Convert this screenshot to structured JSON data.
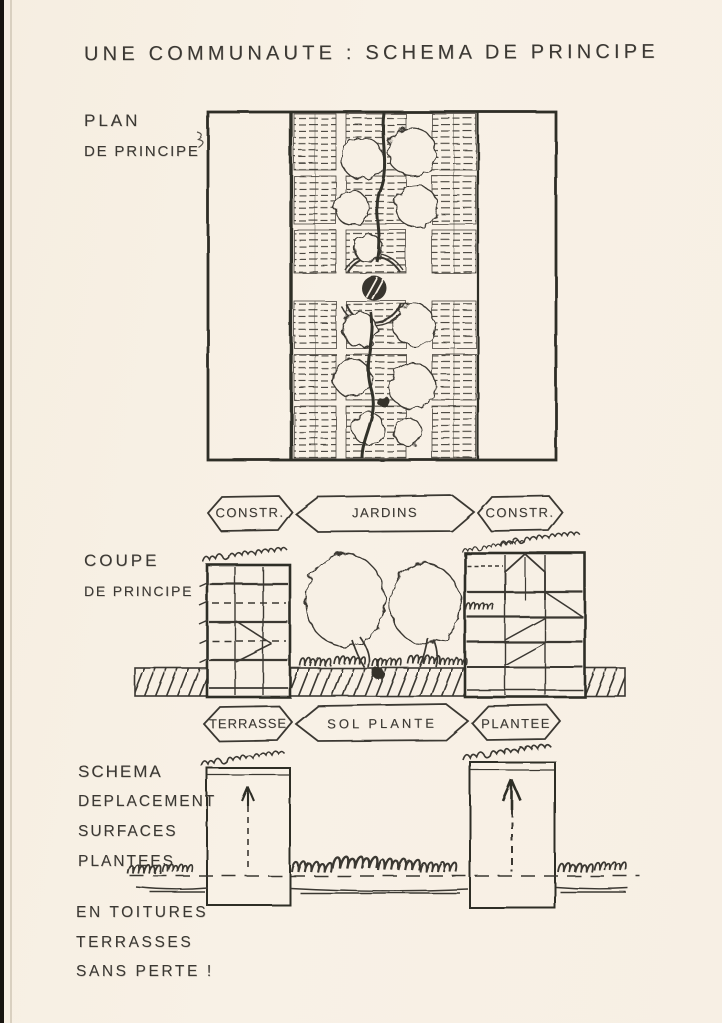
{
  "title": "UNE COMMUNAUTE : SCHEMA DE PRINCIPE",
  "colors": {
    "paper": "#f7f0e5",
    "ink": "#3b3833"
  },
  "plan_section": {
    "label_line1": "PLAN",
    "label_line2": "DE PRINCIPE",
    "tags": {
      "left": "CONSTR.",
      "center": "JARDINS",
      "right": "CONSTR."
    }
  },
  "coupe_section": {
    "label_line1": "COUPE",
    "label_line2": "DE PRINCIPE",
    "tags": {
      "left": "TERRASSE",
      "center": "SOL PLANTE",
      "right": "PLANTEE"
    }
  },
  "schema_section": {
    "label_lines": [
      "SCHEMA",
      "DEPLACEMENT",
      "SURFACES",
      "PLANTEES"
    ],
    "note_lines": [
      "EN TOITURES",
      "TERRASSES",
      "SANS PERTE !"
    ]
  }
}
